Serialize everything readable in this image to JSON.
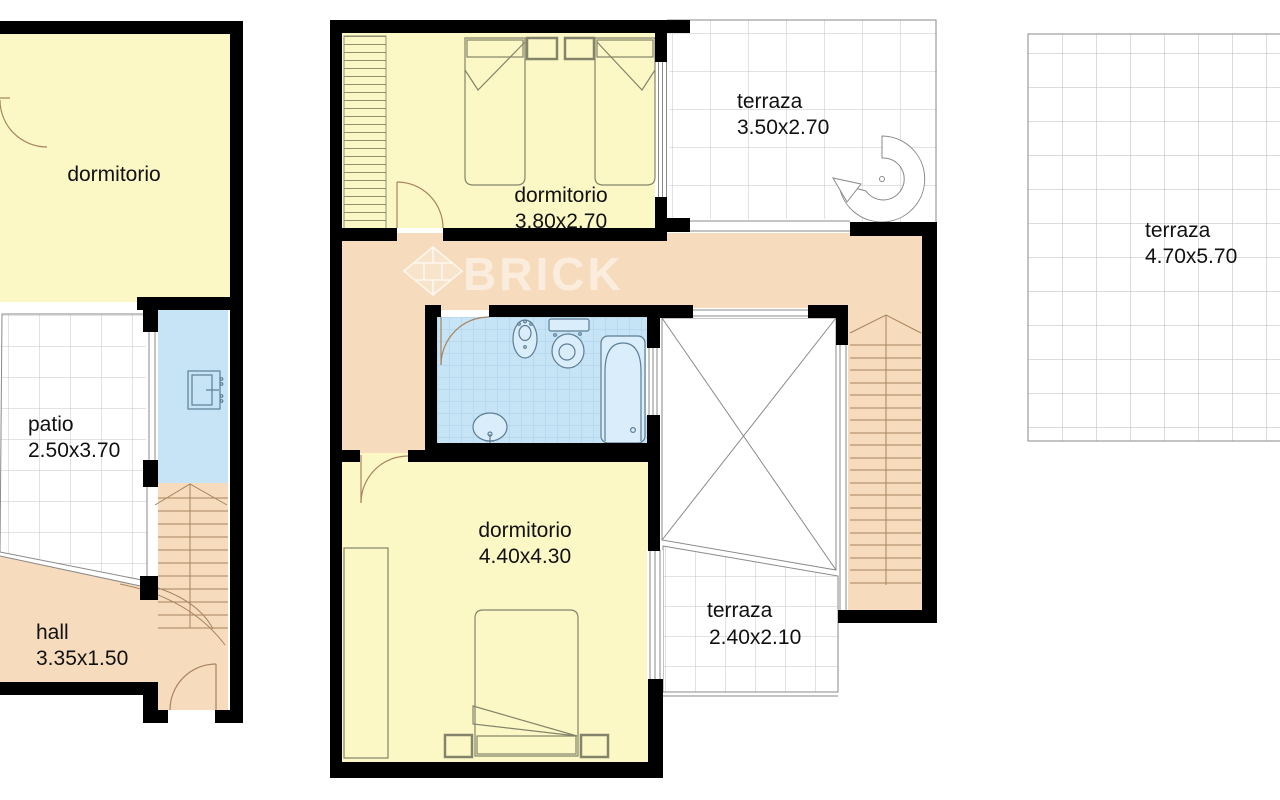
{
  "watermark": {
    "brand": "BRICK"
  },
  "plans": {
    "left": {
      "dormitorio": {
        "label": "dormitorio"
      },
      "patio": {
        "label": "patio",
        "dims": "2.50x3.70"
      },
      "hall": {
        "label": "hall",
        "dims": "3.35x1.50"
      }
    },
    "middle": {
      "dormitorio_top": {
        "label": "dormitorio",
        "dims": "3.80x2.70"
      },
      "terraza_top": {
        "label": "terraza",
        "dims": "3.50x2.70"
      },
      "dormitorio_main": {
        "label": "dormitorio",
        "dims": "4.40x4.30"
      },
      "terraza_small": {
        "label": "terraza",
        "dims": "2.40x2.10"
      }
    },
    "right": {
      "terraza": {
        "label": "terraza",
        "dims": "4.70x5.70"
      }
    }
  },
  "colors": {
    "room_yellow": "#fbf8c6",
    "circulation_tan": "#f6dcbd",
    "wet_blue": "#c6e4f5",
    "wall_black": "#000000",
    "tile_line": "#c6c6c6",
    "outline_gray": "#8a8a8a",
    "furniture_line": "#84846a",
    "step_line": "#a8835f",
    "fixture_line": "#5d7d95",
    "label_text": "#111111",
    "watermark_white": "#ffffff"
  }
}
